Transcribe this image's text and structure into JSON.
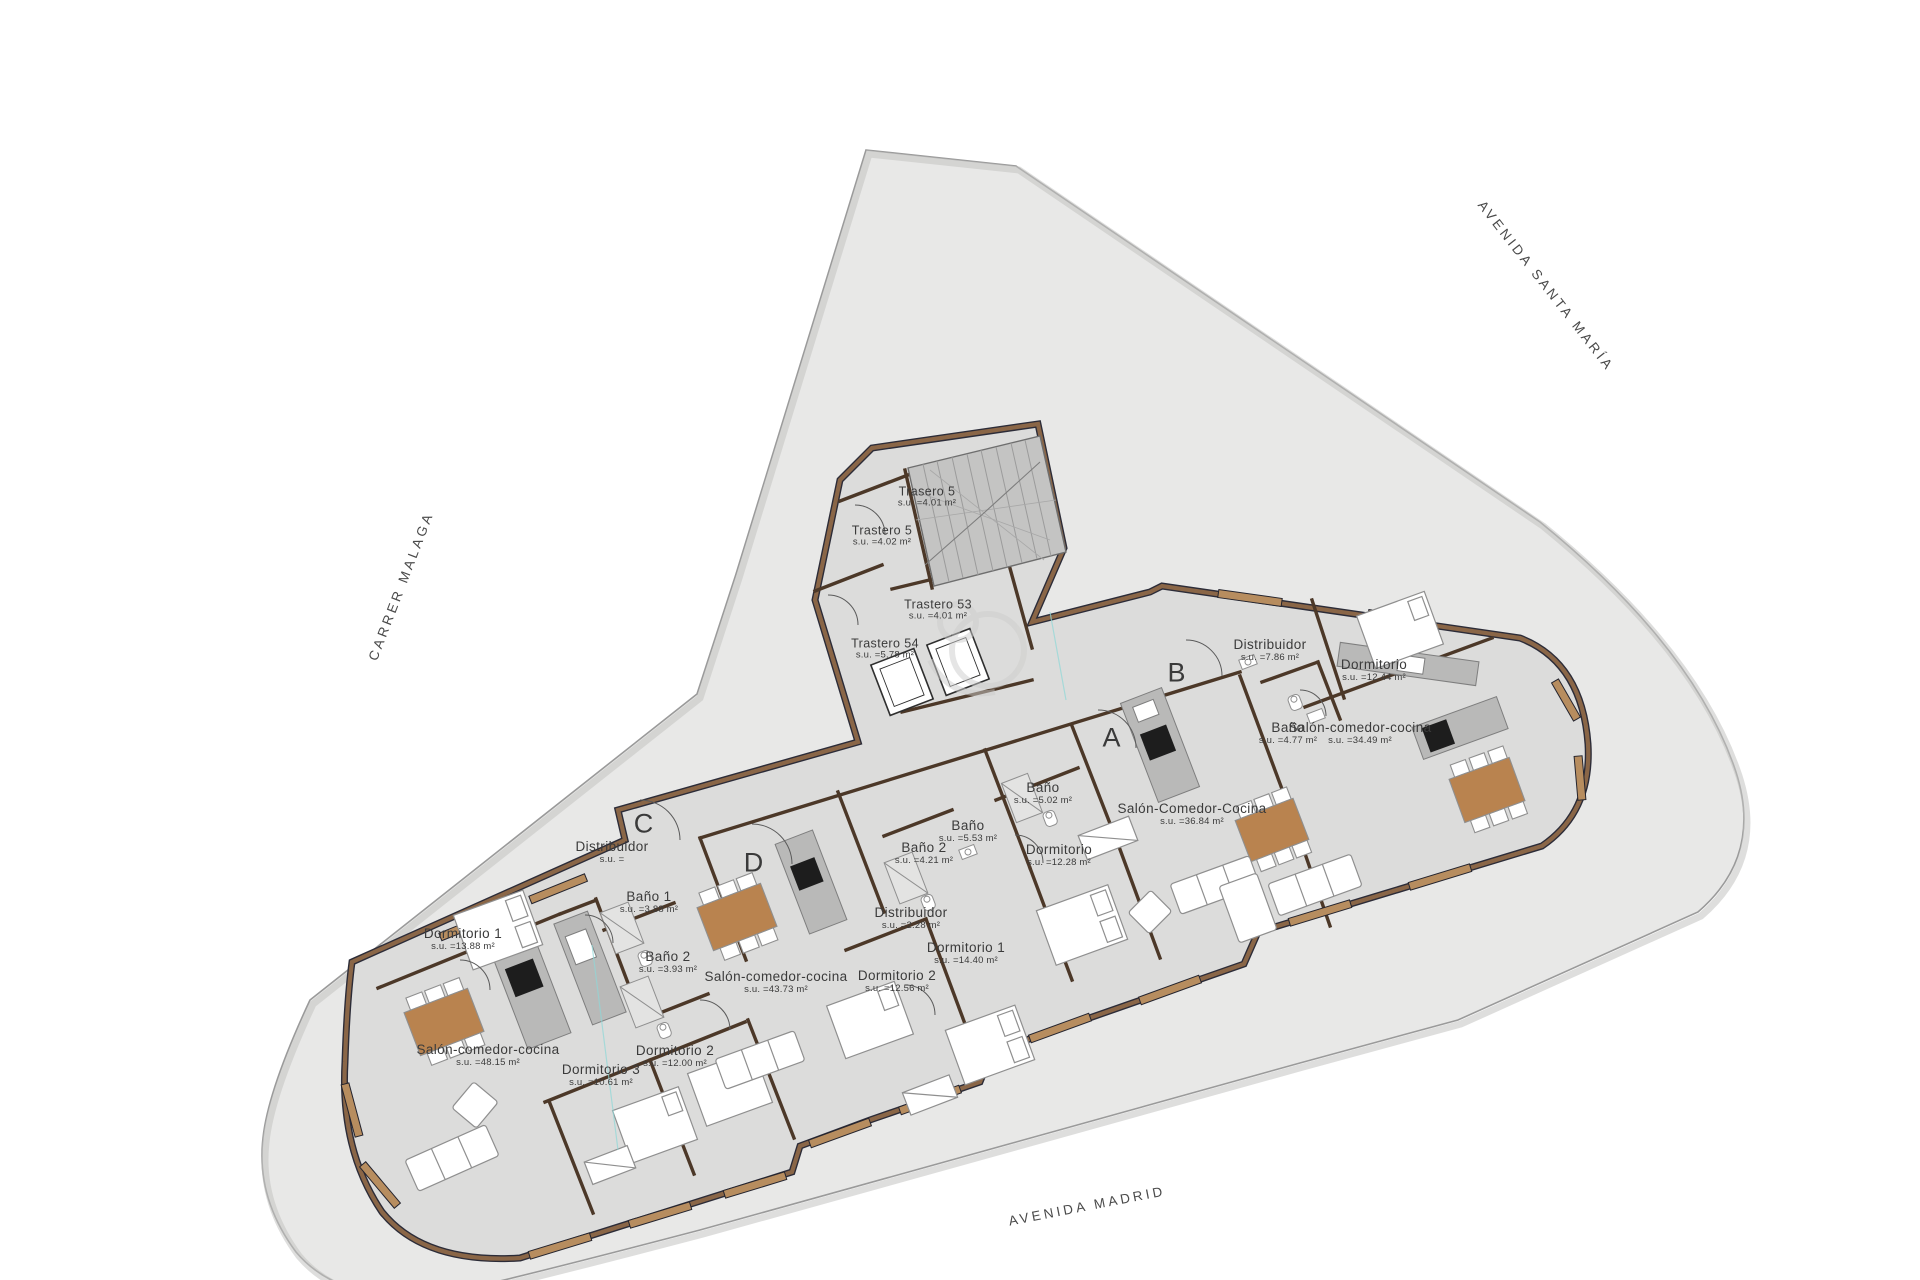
{
  "plan": {
    "streets": {
      "avenida_santa_maria": "AVENIDA SANTA MARÍA",
      "carrer_malaga": "CARRER MALAGA",
      "avenida_madrid": "AVENIDA MADRID"
    },
    "unit_markers": {
      "a": "A",
      "b": "B",
      "c": "C",
      "d": "D"
    },
    "rooms": [
      {
        "name": "Dormitorio 1",
        "area": "s.u. =13.88 m²"
      },
      {
        "name": "Salón-comedor-cocina",
        "area": "s.u. =48.15 m²"
      },
      {
        "name": "Dormitorio 3",
        "area": "s.u. =10.61 m²"
      },
      {
        "name": "Dormitorio 2",
        "area": "s.u. =12.00 m²"
      },
      {
        "name": "Baño 1",
        "area": "s.u. =3.88 m²"
      },
      {
        "name": "Baño 2",
        "area": "s.u. =3.93 m²"
      },
      {
        "name": "Distribuidor",
        "area": "s.u. ="
      },
      {
        "name": "Salón-comedor-cocina",
        "area": "s.u. =43.73 m²"
      },
      {
        "name": "Dormitorio 2",
        "area": "s.u. =12.56 m²"
      },
      {
        "name": "Dormitorio 1",
        "area": "s.u. =14.40 m²"
      },
      {
        "name": "Distribuidor",
        "area": "s.u. =2.28 m²"
      },
      {
        "name": "Baño 2",
        "area": "s.u. =4.21 m²"
      },
      {
        "name": "Baño",
        "area": "s.u. =5.53 m²"
      },
      {
        "name": "Baño",
        "area": "s.u. =5.02 m²"
      },
      {
        "name": "Dormitorio",
        "area": "s.u. =12.28 m²"
      },
      {
        "name": "Salón-Comedor-Cocina",
        "area": "s.u. =36.84 m²"
      },
      {
        "name": "Distribuidor",
        "area": "s.u. =7.86 m²"
      },
      {
        "name": "Dormitorio",
        "area": "s.u. =12.44 m²"
      },
      {
        "name": "Baño",
        "area": "s.u. =4.77 m²"
      },
      {
        "name": "Salón-comedor-cocina",
        "area": "s.u. =34.49 m²"
      },
      {
        "name": "Trasero 5",
        "area": "s.u. =4.01 m²"
      },
      {
        "name": "Trastero 5",
        "area": "s.u. =4.02 m²"
      },
      {
        "name": "Trastero 53",
        "area": "s.u. =4.01 m²"
      },
      {
        "name": "Trastero 54",
        "area": "s.u. =5.78 m²"
      }
    ],
    "colors": {
      "parcel": "#e8e8e7",
      "floor": "#dcdcdb",
      "wall": "#8a6647",
      "wall_edge": "#2c2c38",
      "window_sill": "#b78d5f",
      "kitchen_counter": "#b9b9b8",
      "cooktop": "#1d1d1d",
      "dining_table": "#b9834f",
      "stairs": "#c4c4c3"
    }
  }
}
